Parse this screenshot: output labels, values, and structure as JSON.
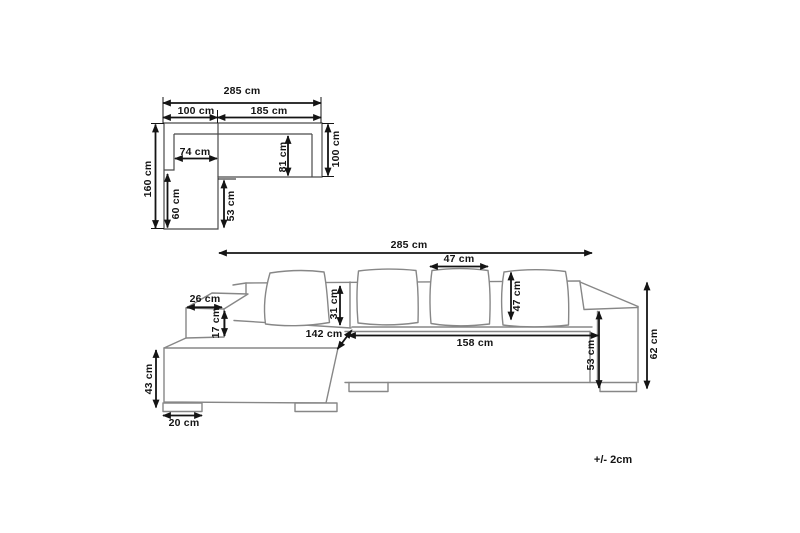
{
  "diagram": {
    "type": "sofa-dimension-diagram",
    "tolerance_note": "+/- 2cm",
    "top_view": {
      "overall_width": "285 cm",
      "left_section_width": "100 cm",
      "right_section_width": "185 cm",
      "chaise_seat_width": "74 cm",
      "left_section_depth": "160 cm",
      "chaise_inner_length": "60 cm",
      "chaise_front_offset": "53 cm",
      "seat_depth": "81 cm",
      "right_section_depth": "100 cm"
    },
    "front_view": {
      "overall_width": "285 cm",
      "cushion_width": "47 cm",
      "cushion_height": "47 cm",
      "backrest_above_seat": "31 cm",
      "armrest_depth": "26 cm",
      "armrest_above_seat": "17 cm",
      "chaise_length": "142 cm",
      "seat_front_width": "158 cm",
      "armrest_height": "53 cm",
      "total_height": "62 cm",
      "seat_height": "43 cm",
      "foot_width": "20 cm"
    },
    "colors": {
      "background": "#ffffff",
      "plan_line": "#4a4a4a",
      "sofa_line": "#878787",
      "dimension": "#141414"
    }
  }
}
